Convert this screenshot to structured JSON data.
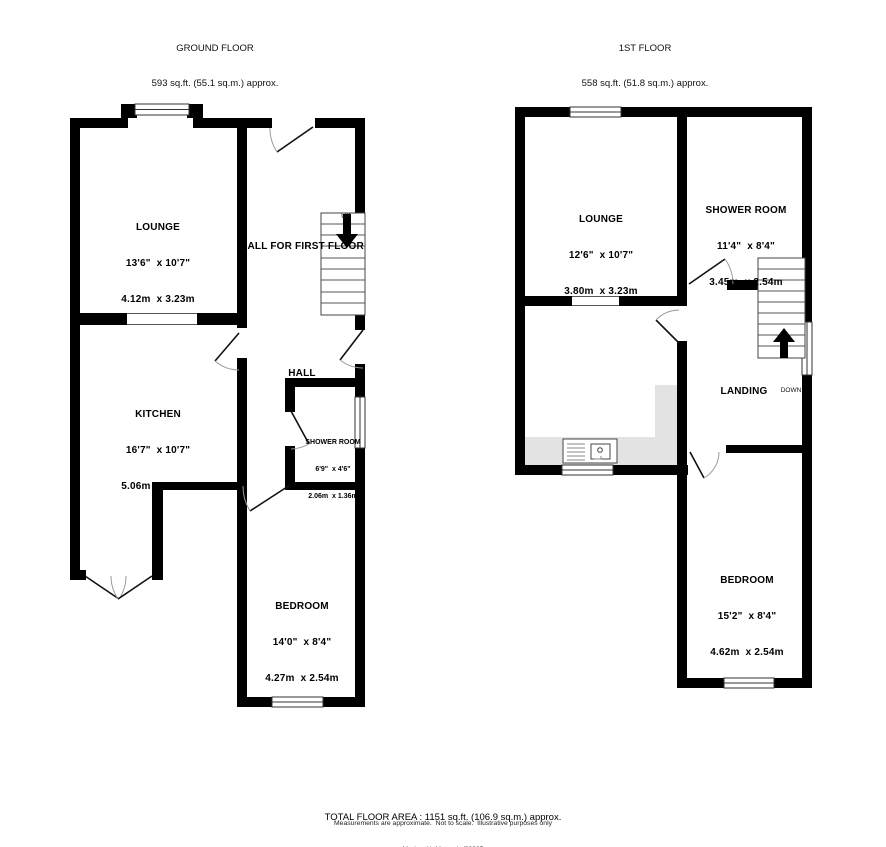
{
  "ground_floor": {
    "title": "GROUND FLOOR",
    "area": "593 sq.ft. (55.1 sq.m.) approx.",
    "rooms": {
      "lounge": {
        "name": "LOUNGE",
        "imperial": "13'6\"  x 10'7\"",
        "metric": "4.12m  x 3.23m"
      },
      "kitchen": {
        "name": "KITCHEN",
        "imperial": "16'7\"  x 10'7\"",
        "metric": "5.06m  x 3.23m"
      },
      "shower": {
        "name": "SHOWER ROOM",
        "imperial": "6'9\"  x 4'6\"",
        "metric": "2.06m  x 1.36m"
      },
      "bedroom": {
        "name": "BEDROOM",
        "imperial": "14'0\"  x 8'4\"",
        "metric": "4.27m  x 2.54m"
      }
    },
    "labels": {
      "hall_for_first_floor": "HALL FOR FIRST FLOOR",
      "hall": "HALL",
      "up": "UP"
    }
  },
  "first_floor": {
    "title": "1ST FLOOR",
    "area": "558 sq.ft. (51.8 sq.m.) approx.",
    "rooms": {
      "lounge": {
        "name": "LOUNGE",
        "imperial": "12'6\"  x 10'7\"",
        "metric": "3.80m  x 3.23m"
      },
      "shower": {
        "name": "SHOWER ROOM",
        "imperial": "11'4\"  x 8'4\"",
        "metric": "3.45m  x 2.54m"
      },
      "bedroom": {
        "name": "BEDROOM",
        "imperial": "15'2\"  x 8'4\"",
        "metric": "4.62m  x 2.54m"
      }
    },
    "labels": {
      "landing": "LANDING",
      "down": "DOWN"
    }
  },
  "footer": {
    "total": "TOTAL FLOOR AREA : 1151 sq.ft. (106.9 sq.m.) approx.",
    "disclaimer": "Measurements are approximate.  Not to scale.  Illustrative purposes only",
    "credit": "Made with Metropix ©2025"
  }
}
